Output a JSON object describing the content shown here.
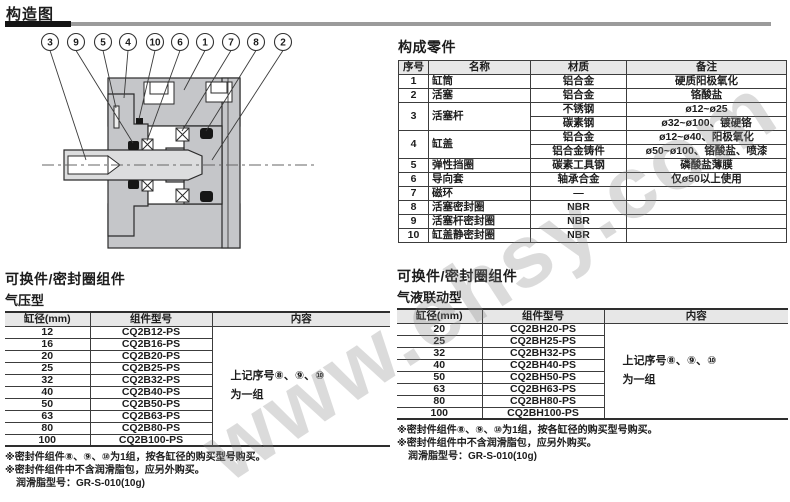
{
  "page": {
    "title": "构造图"
  },
  "watermark": "www.ehsy.com",
  "colors": {
    "rule_dark": "#141414",
    "rule_gray": "#9b9b9b",
    "table_header_bg": "#e7e7e7",
    "body_gray": "#c5c6c9",
    "rod_gray": "#dcddDF",
    "seal_black": "#161616"
  },
  "diagram": {
    "callouts": [
      "3",
      "9",
      "5",
      "4",
      "10",
      "6",
      "1",
      "7",
      "8",
      "2"
    ]
  },
  "parts": {
    "title": "构成零件",
    "headers": [
      "序号",
      "名称",
      "材质",
      "备注"
    ],
    "rows": [
      {
        "no": "1",
        "name": "缸筒",
        "cells": [
          [
            "铝合金",
            "硬质阳极氧化"
          ]
        ]
      },
      {
        "no": "2",
        "name": "活塞",
        "cells": [
          [
            "铝合金",
            "铬酸盐"
          ]
        ]
      },
      {
        "no": "3",
        "name": "活塞杆",
        "cells": [
          [
            "不锈钢",
            "ø12~ø25"
          ],
          [
            "碳素钢",
            "ø32~ø100、镀硬铬"
          ]
        ]
      },
      {
        "no": "4",
        "name": "缸盖",
        "cells": [
          [
            "铝合金",
            "ø12~ø40、阳极氧化"
          ],
          [
            "铝合金铸件",
            "ø50~ø100、铬酸盐、喷漆"
          ]
        ]
      },
      {
        "no": "5",
        "name": "弹性挡圈",
        "cells": [
          [
            "碳素工具钢",
            "磷酸盐薄膜"
          ]
        ]
      },
      {
        "no": "6",
        "name": "导向套",
        "cells": [
          [
            "轴承合金",
            "仅ø50以上使用"
          ]
        ]
      },
      {
        "no": "7",
        "name": "磁环",
        "cells": [
          [
            "—",
            ""
          ]
        ]
      },
      {
        "no": "8",
        "name": "活塞密封圈",
        "cells": [
          [
            "NBR",
            ""
          ]
        ]
      },
      {
        "no": "9",
        "name": "活塞杆密封圈",
        "cells": [
          [
            "NBR",
            ""
          ]
        ]
      },
      {
        "no": "10",
        "name": "缸盖静密封圈",
        "cells": [
          [
            "NBR",
            ""
          ]
        ]
      }
    ]
  },
  "kits": [
    {
      "title": "可换件/密封圈组件",
      "subtitle": "气压型",
      "headers": [
        "缸径(mm)",
        "组件型号",
        "内容"
      ],
      "rows": [
        [
          "12",
          "CQ2B12-PS"
        ],
        [
          "16",
          "CQ2B16-PS"
        ],
        [
          "20",
          "CQ2B20-PS"
        ],
        [
          "25",
          "CQ2B25-PS"
        ],
        [
          "32",
          "CQ2B32-PS"
        ],
        [
          "40",
          "CQ2B40-PS"
        ],
        [
          "50",
          "CQ2B50-PS"
        ],
        [
          "63",
          "CQ2B63-PS"
        ],
        [
          "80",
          "CQ2B80-PS"
        ],
        [
          "100",
          "CQ2B100-PS"
        ]
      ],
      "content_lines": [
        "上记序号⑧、⑨、⑩",
        "为一组"
      ],
      "notes": [
        "※密封件组件⑧、⑨、⑩为1组，按各缸径的购买型号购买。",
        "※密封件组件中不含润滑脂包，应另外购买。",
        "润滑脂型号：GR-S-010(10g)"
      ]
    },
    {
      "title": "可换件/密封圈组件",
      "subtitle": "气液联动型",
      "headers": [
        "缸径(mm)",
        "组件型号",
        "内容"
      ],
      "rows": [
        [
          "20",
          "CQ2BH20-PS"
        ],
        [
          "25",
          "CQ2BH25-PS"
        ],
        [
          "32",
          "CQ2BH32-PS"
        ],
        [
          "40",
          "CQ2BH40-PS"
        ],
        [
          "50",
          "CQ2BH50-PS"
        ],
        [
          "63",
          "CQ2BH63-PS"
        ],
        [
          "80",
          "CQ2BH80-PS"
        ],
        [
          "100",
          "CQ2BH100-PS"
        ]
      ],
      "content_lines": [
        "上记序号⑧、⑨、⑩",
        "为一组"
      ],
      "notes": [
        "※密封件组件⑧、⑨、⑩为1组，按各缸径的购买型号购买。",
        "※密封件组件中不含润滑脂包，应另外购买。",
        "润滑脂型号：GR-S-010(10g)"
      ]
    }
  ]
}
